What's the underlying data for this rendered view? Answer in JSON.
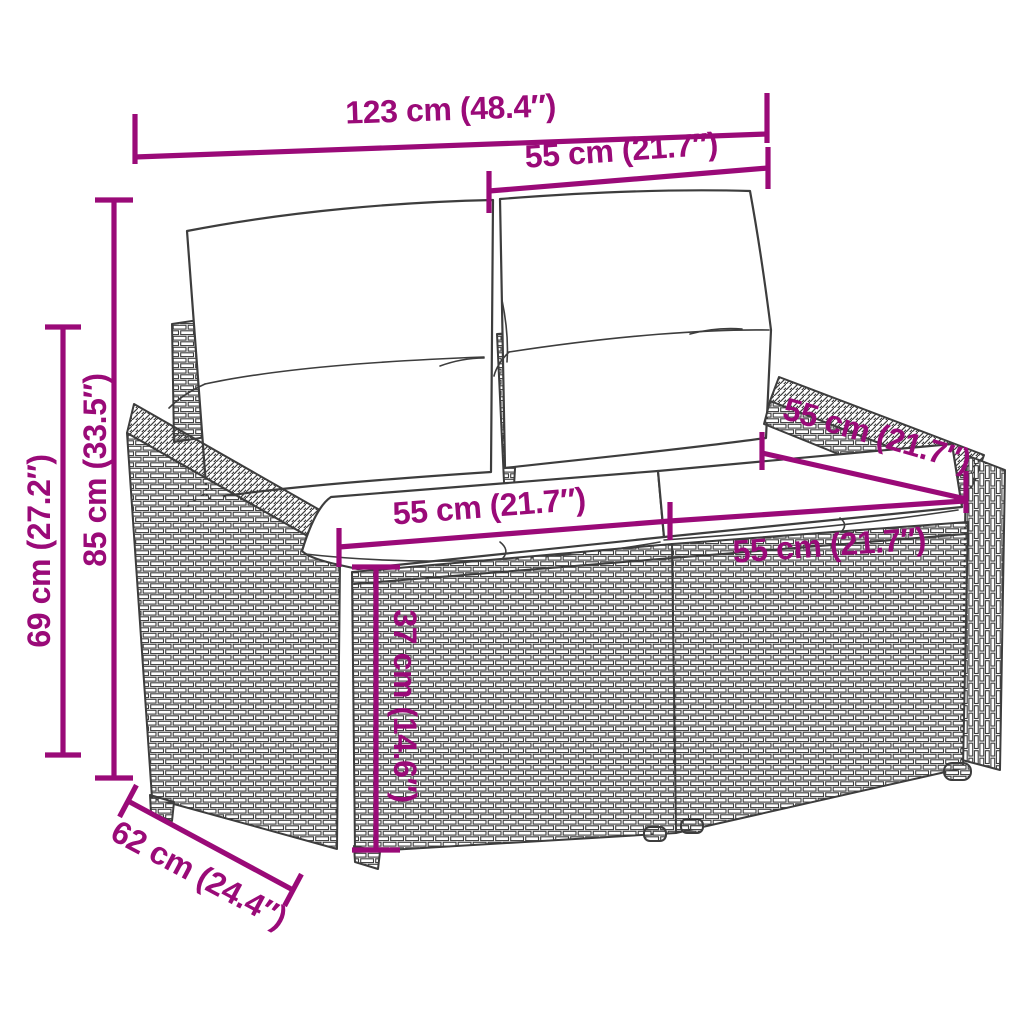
{
  "diagram": {
    "title": "Garden sofa dimension diagram",
    "product": "poly-rattan-2-seater-garden-sofa-with-cushions",
    "colors": {
      "dimension": "#9A0A78",
      "line_art": "#3D3D3D",
      "background": "#FFFFFF"
    },
    "dimensions": [
      {
        "id": "overall-width",
        "label": "123 cm (48.4″)"
      },
      {
        "id": "back-cushion-width",
        "label": "55 cm (21.7″)"
      },
      {
        "id": "overall-height",
        "label": "85 cm (33.5″)"
      },
      {
        "id": "armrest-height",
        "label": "69 cm (27.2″)"
      },
      {
        "id": "seat-depth",
        "label": "55 cm (21.7″)"
      },
      {
        "id": "seat-width-left",
        "label": "55 cm (21.7″)"
      },
      {
        "id": "seat-width-right",
        "label": "55 cm (21.7″)"
      },
      {
        "id": "seat-height",
        "label": "37 cm (14.6″)"
      },
      {
        "id": "overall-depth",
        "label": "62 cm (24.4″)"
      }
    ]
  }
}
